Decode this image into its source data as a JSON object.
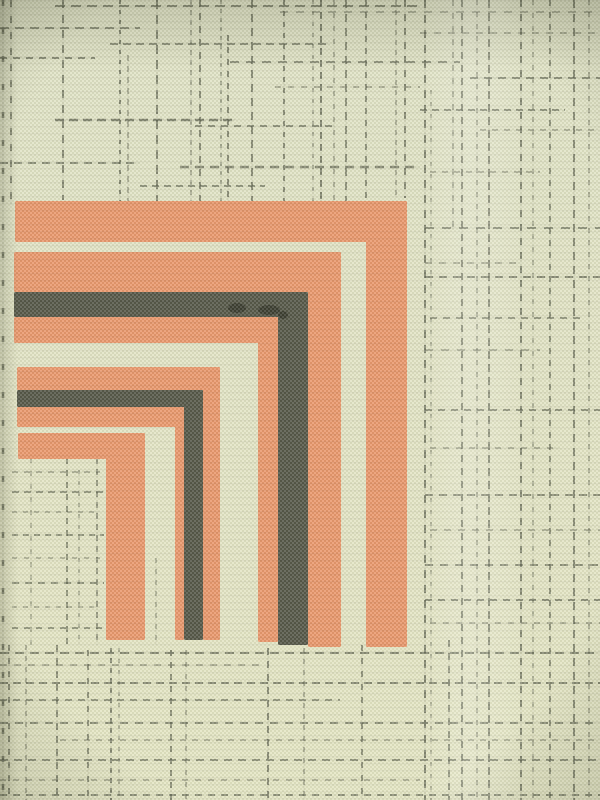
{
  "scene": {
    "description": "Close-up photograph of woven fabric: pale green-cream ground with dashed dark-olive plaid lines and a printed corner motif of nested orange and black right-angle bands opening toward the lower left",
    "type": "textile-photograph"
  },
  "canvas": {
    "width": 600,
    "height": 800
  },
  "palette": {
    "background_top": "#dee1c5",
    "background_bottom": "#e3e4c3",
    "plaid_line": "#4d5140",
    "orange": "#e98a5e",
    "black": "#3d3f33",
    "weave_dark": "#aeb192",
    "weave_light": "#f7f7e6",
    "smudge": "#181a12",
    "shadow": "#23261442"
  },
  "motif": {
    "bands": [
      {
        "name": "bracket1-orange-outer",
        "color": "orange",
        "arm": {
          "x": 15,
          "y": 201,
          "w": 392,
          "h": 41
        },
        "leg": {
          "x": 366,
          "y": 201,
          "w": 41,
          "h": 446
        }
      },
      {
        "name": "bracket2-orange-outer",
        "color": "orange",
        "arm": {
          "x": 14,
          "y": 252,
          "w": 327,
          "h": 40
        },
        "leg": {
          "x": 308,
          "y": 252,
          "w": 33,
          "h": 395
        }
      },
      {
        "name": "bracket2-black",
        "color": "black",
        "arm": {
          "x": 14,
          "y": 292,
          "w": 294,
          "h": 25
        },
        "leg": {
          "x": 278,
          "y": 292,
          "w": 30,
          "h": 353
        }
      },
      {
        "name": "bracket2-orange-inner",
        "color": "orange",
        "arm": {
          "x": 14,
          "y": 317,
          "w": 264,
          "h": 26
        },
        "leg": {
          "x": 258,
          "y": 317,
          "w": 20,
          "h": 325
        }
      },
      {
        "name": "bracket3-orange-outer",
        "color": "orange",
        "arm": {
          "x": 17,
          "y": 367,
          "w": 203,
          "h": 23
        },
        "leg": {
          "x": 203,
          "y": 367,
          "w": 17,
          "h": 273
        }
      },
      {
        "name": "bracket3-black",
        "color": "black",
        "arm": {
          "x": 17,
          "y": 390,
          "w": 186,
          "h": 17
        },
        "leg": {
          "x": 184,
          "y": 390,
          "w": 19,
          "h": 250
        }
      },
      {
        "name": "bracket3-orange-inner",
        "color": "orange",
        "arm": {
          "x": 17,
          "y": 407,
          "w": 167,
          "h": 20
        },
        "leg": {
          "x": 175,
          "y": 407,
          "w": 9,
          "h": 233
        }
      },
      {
        "name": "bracket4-orange-inner",
        "color": "orange",
        "arm": {
          "x": 18,
          "y": 433,
          "w": 127,
          "h": 26
        },
        "leg": {
          "x": 106,
          "y": 433,
          "w": 39,
          "h": 207
        }
      }
    ],
    "smudges": [
      {
        "cx": 237,
        "cy": 308,
        "rx": 9,
        "ry": 5
      },
      {
        "cx": 269,
        "cy": 310,
        "rx": 11,
        "ry": 5
      },
      {
        "cx": 283,
        "cy": 315,
        "rx": 5,
        "ry": 4
      }
    ]
  },
  "plaid": {
    "vlines": [
      {
        "x": 3,
        "y1": 0,
        "y2": 800,
        "dash": "6,22",
        "w": 2.5,
        "o": 0.8
      },
      {
        "x": 11,
        "y1": 0,
        "y2": 205,
        "dash": "7,9",
        "w": 2,
        "o": 0.7
      },
      {
        "x": 63,
        "y1": 0,
        "y2": 200,
        "dash": "8,7",
        "w": 2,
        "o": 0.7
      },
      {
        "x": 120,
        "y1": 0,
        "y2": 202,
        "dash": "4,6",
        "w": 2,
        "o": 0.75
      },
      {
        "x": 128,
        "y1": 55,
        "y2": 202,
        "dash": "6,5",
        "w": 1.5,
        "o": 0.55
      },
      {
        "x": 157,
        "y1": 0,
        "y2": 202,
        "dash": "9,6",
        "w": 2,
        "o": 0.7
      },
      {
        "x": 191,
        "y1": 0,
        "y2": 202,
        "dash": "5,5",
        "w": 1.5,
        "o": 0.55
      },
      {
        "x": 200,
        "y1": 0,
        "y2": 202,
        "dash": "7,6",
        "w": 2,
        "o": 0.7
      },
      {
        "x": 221,
        "y1": 0,
        "y2": 202,
        "dash": "4,5",
        "w": 1.5,
        "o": 0.6
      },
      {
        "x": 228,
        "y1": 35,
        "y2": 202,
        "dash": "6,6",
        "w": 2,
        "o": 0.7
      },
      {
        "x": 252,
        "y1": 0,
        "y2": 202,
        "dash": "8,6",
        "w": 2,
        "o": 0.7
      },
      {
        "x": 284,
        "y1": 0,
        "y2": 202,
        "dash": "5,6",
        "w": 2,
        "o": 0.7
      },
      {
        "x": 313,
        "y1": 0,
        "y2": 202,
        "dash": "4,7",
        "w": 1.5,
        "o": 0.55
      },
      {
        "x": 321,
        "y1": 0,
        "y2": 202,
        "dash": "7,5",
        "w": 2,
        "o": 0.75
      },
      {
        "x": 334,
        "y1": 0,
        "y2": 202,
        "dash": "5,8",
        "w": 1.5,
        "o": 0.55
      },
      {
        "x": 346,
        "y1": 0,
        "y2": 202,
        "dash": "8,6",
        "w": 2,
        "o": 0.65
      },
      {
        "x": 366,
        "y1": 0,
        "y2": 198,
        "dash": "6,6",
        "w": 2,
        "o": 0.65
      },
      {
        "x": 396,
        "y1": 0,
        "y2": 198,
        "dash": "5,5",
        "w": 1.5,
        "o": 0.55
      },
      {
        "x": 405,
        "y1": 0,
        "y2": 198,
        "dash": "7,7",
        "w": 2,
        "o": 0.7
      },
      {
        "x": 425,
        "y1": 0,
        "y2": 800,
        "dash": "8,7",
        "w": 2,
        "o": 0.75
      },
      {
        "x": 431,
        "y1": 90,
        "y2": 800,
        "dash": "4,8",
        "w": 1.5,
        "o": 0.5
      },
      {
        "x": 453,
        "y1": 0,
        "y2": 230,
        "dash": "6,7",
        "w": 1.5,
        "o": 0.55
      },
      {
        "x": 449,
        "y1": 640,
        "y2": 800,
        "dash": "7,6",
        "w": 2,
        "o": 0.65
      },
      {
        "x": 462,
        "y1": 0,
        "y2": 800,
        "dash": "7,6",
        "w": 2,
        "o": 0.7
      },
      {
        "x": 477,
        "y1": 0,
        "y2": 800,
        "dash": "5,7",
        "w": 1.5,
        "o": 0.55
      },
      {
        "x": 489,
        "y1": 0,
        "y2": 800,
        "dash": "8,5",
        "w": 2,
        "o": 0.7
      },
      {
        "x": 521,
        "y1": 0,
        "y2": 800,
        "dash": "7,7",
        "w": 2,
        "o": 0.75
      },
      {
        "x": 533,
        "y1": 0,
        "y2": 800,
        "dash": "5,8",
        "w": 1.5,
        "o": 0.5
      },
      {
        "x": 550,
        "y1": 0,
        "y2": 800,
        "dash": "6,6",
        "w": 2,
        "o": 0.65
      },
      {
        "x": 574,
        "y1": 0,
        "y2": 800,
        "dash": "8,6",
        "w": 2,
        "o": 0.7
      },
      {
        "x": 589,
        "y1": 0,
        "y2": 800,
        "dash": "5,7",
        "w": 1.5,
        "o": 0.55
      },
      {
        "x": 9,
        "y1": 645,
        "y2": 800,
        "dash": "6,7",
        "w": 2,
        "o": 0.65
      },
      {
        "x": 26,
        "y1": 645,
        "y2": 800,
        "dash": "5,6",
        "w": 1.5,
        "o": 0.55
      },
      {
        "x": 57,
        "y1": 645,
        "y2": 800,
        "dash": "7,6",
        "w": 2,
        "o": 0.65
      },
      {
        "x": 88,
        "y1": 650,
        "y2": 800,
        "dash": "6,8",
        "w": 2,
        "o": 0.65
      },
      {
        "x": 111,
        "y1": 648,
        "y2": 800,
        "dash": "5,5",
        "w": 2,
        "o": 0.7
      },
      {
        "x": 119,
        "y1": 648,
        "y2": 800,
        "dash": "4,7",
        "w": 1.5,
        "o": 0.5
      },
      {
        "x": 171,
        "y1": 650,
        "y2": 800,
        "dash": "6,6",
        "w": 2,
        "o": 0.65
      },
      {
        "x": 186,
        "y1": 650,
        "y2": 800,
        "dash": "5,7",
        "w": 1.5,
        "o": 0.55
      },
      {
        "x": 268,
        "y1": 648,
        "y2": 800,
        "dash": "7,6",
        "w": 2,
        "o": 0.7
      },
      {
        "x": 304,
        "y1": 648,
        "y2": 800,
        "dash": "5,6",
        "w": 1.5,
        "o": 0.55
      },
      {
        "x": 362,
        "y1": 645,
        "y2": 800,
        "dash": "6,7",
        "w": 2,
        "o": 0.65
      },
      {
        "x": 31,
        "y1": 458,
        "y2": 645,
        "dash": "5,8",
        "w": 1.5,
        "o": 0.45
      },
      {
        "x": 67,
        "y1": 458,
        "y2": 645,
        "dash": "6,6",
        "w": 2,
        "o": 0.6
      },
      {
        "x": 79,
        "y1": 470,
        "y2": 645,
        "dash": "4,7",
        "w": 1.5,
        "o": 0.5
      },
      {
        "x": 97,
        "y1": 458,
        "y2": 645,
        "dash": "6,5",
        "w": 2,
        "o": 0.55
      },
      {
        "x": 156,
        "y1": 558,
        "y2": 645,
        "dash": "5,6",
        "w": 1.5,
        "o": 0.5
      }
    ],
    "hlines": [
      {
        "y": 6,
        "x1": 55,
        "x2": 420,
        "dash": "10,6",
        "w": 2,
        "o": 0.7
      },
      {
        "y": 12,
        "x1": 280,
        "x2": 600,
        "dash": "8,8",
        "w": 1.5,
        "o": 0.55
      },
      {
        "y": 28,
        "x1": 0,
        "x2": 140,
        "dash": "9,6",
        "w": 2,
        "o": 0.65
      },
      {
        "y": 33,
        "x1": 420,
        "x2": 600,
        "dash": "7,7",
        "w": 1.5,
        "o": 0.55
      },
      {
        "y": 44,
        "x1": 110,
        "x2": 330,
        "dash": "8,5",
        "w": 2,
        "o": 0.65
      },
      {
        "y": 58,
        "x1": 0,
        "x2": 95,
        "dash": "7,6",
        "w": 2,
        "o": 0.7
      },
      {
        "y": 62,
        "x1": 230,
        "x2": 460,
        "dash": "9,7",
        "w": 2,
        "o": 0.65
      },
      {
        "y": 78,
        "x1": 470,
        "x2": 600,
        "dash": "8,6",
        "w": 2,
        "o": 0.65
      },
      {
        "y": 87,
        "x1": 275,
        "x2": 420,
        "dash": "6,7",
        "w": 1.5,
        "o": 0.55
      },
      {
        "y": 110,
        "x1": 420,
        "x2": 565,
        "dash": "7,5",
        "w": 2,
        "o": 0.65
      },
      {
        "y": 120,
        "x1": 55,
        "x2": 235,
        "dash": "9,5",
        "w": 2.5,
        "o": 0.75
      },
      {
        "y": 126,
        "x1": 195,
        "x2": 335,
        "dash": "7,6",
        "w": 2,
        "o": 0.65
      },
      {
        "y": 130,
        "x1": 480,
        "x2": 600,
        "dash": "6,6",
        "w": 1.5,
        "o": 0.55
      },
      {
        "y": 163,
        "x1": 0,
        "x2": 140,
        "dash": "8,6",
        "w": 2,
        "o": 0.65
      },
      {
        "y": 167,
        "x1": 180,
        "x2": 420,
        "dash": "9,6",
        "w": 2.5,
        "o": 0.7
      },
      {
        "y": 172,
        "x1": 430,
        "x2": 540,
        "dash": "6,6",
        "w": 1.5,
        "o": 0.55
      },
      {
        "y": 186,
        "x1": 140,
        "x2": 265,
        "dash": "7,5",
        "w": 2,
        "o": 0.65
      },
      {
        "y": 228,
        "x1": 425,
        "x2": 600,
        "dash": "9,8",
        "w": 2,
        "o": 0.65
      },
      {
        "y": 263,
        "x1": 425,
        "x2": 520,
        "dash": "7,7",
        "w": 1.5,
        "o": 0.55
      },
      {
        "y": 277,
        "x1": 425,
        "x2": 600,
        "dash": "8,6",
        "w": 2,
        "o": 0.7
      },
      {
        "y": 318,
        "x1": 430,
        "x2": 580,
        "dash": "7,6",
        "w": 2,
        "o": 0.6
      },
      {
        "y": 350,
        "x1": 425,
        "x2": 540,
        "dash": "8,8",
        "w": 1.5,
        "o": 0.55
      },
      {
        "y": 410,
        "x1": 425,
        "x2": 600,
        "dash": "7,6",
        "w": 2,
        "o": 0.65
      },
      {
        "y": 448,
        "x1": 430,
        "x2": 560,
        "dash": "6,7",
        "w": 1.5,
        "o": 0.55
      },
      {
        "y": 495,
        "x1": 425,
        "x2": 600,
        "dash": "8,6",
        "w": 2,
        "o": 0.65
      },
      {
        "y": 530,
        "x1": 430,
        "x2": 600,
        "dash": "7,7",
        "w": 1.5,
        "o": 0.55
      },
      {
        "y": 565,
        "x1": 425,
        "x2": 600,
        "dash": "8,7",
        "w": 2,
        "o": 0.65
      },
      {
        "y": 600,
        "x1": 425,
        "x2": 600,
        "dash": "7,6",
        "w": 2,
        "o": 0.7
      },
      {
        "y": 623,
        "x1": 430,
        "x2": 600,
        "dash": "6,7",
        "w": 1.5,
        "o": 0.55
      },
      {
        "y": 472,
        "x1": 12,
        "x2": 100,
        "dash": "6,6",
        "w": 1.5,
        "o": 0.55
      },
      {
        "y": 492,
        "x1": 12,
        "x2": 104,
        "dash": "7,5",
        "w": 2,
        "o": 0.6
      },
      {
        "y": 512,
        "x1": 12,
        "x2": 100,
        "dash": "5,6",
        "w": 1.5,
        "o": 0.5
      },
      {
        "y": 535,
        "x1": 12,
        "x2": 104,
        "dash": "6,5",
        "w": 2,
        "o": 0.6
      },
      {
        "y": 558,
        "x1": 12,
        "x2": 100,
        "dash": "5,7",
        "w": 1.5,
        "o": 0.5
      },
      {
        "y": 583,
        "x1": 12,
        "x2": 104,
        "dash": "7,6",
        "w": 2,
        "o": 0.6
      },
      {
        "y": 607,
        "x1": 12,
        "x2": 100,
        "dash": "5,6",
        "w": 1.5,
        "o": 0.5
      },
      {
        "y": 628,
        "x1": 12,
        "x2": 104,
        "dash": "6,6",
        "w": 2,
        "o": 0.6
      },
      {
        "y": 653,
        "x1": 0,
        "x2": 600,
        "dash": "9,6",
        "w": 2,
        "o": 0.7
      },
      {
        "y": 665,
        "x1": 0,
        "x2": 260,
        "dash": "7,7",
        "w": 1.5,
        "o": 0.55
      },
      {
        "y": 683,
        "x1": 0,
        "x2": 600,
        "dash": "8,5",
        "w": 2,
        "o": 0.7
      },
      {
        "y": 700,
        "x1": 0,
        "x2": 340,
        "dash": "7,6",
        "w": 2,
        "o": 0.6
      },
      {
        "y": 723,
        "x1": 0,
        "x2": 600,
        "dash": "8,7",
        "w": 2,
        "o": 0.65
      },
      {
        "y": 740,
        "x1": 60,
        "x2": 600,
        "dash": "6,6",
        "w": 1.5,
        "o": 0.55
      },
      {
        "y": 760,
        "x1": 0,
        "x2": 600,
        "dash": "8,6",
        "w": 2,
        "o": 0.65
      },
      {
        "y": 780,
        "x1": 0,
        "x2": 420,
        "dash": "6,7",
        "w": 1.5,
        "o": 0.55
      },
      {
        "y": 795,
        "x1": 0,
        "x2": 600,
        "dash": "7,6",
        "w": 2,
        "o": 0.65
      }
    ]
  },
  "lighting": {
    "sheen_x": 420,
    "sheen_w": 110,
    "sheen_opacity": 0.16,
    "top_shadow_h": 70,
    "top_shadow_opacity": 0.14,
    "left_shadow_w": 18,
    "left_shadow_opacity": 0.16,
    "vignette_opacity": 0.16
  }
}
